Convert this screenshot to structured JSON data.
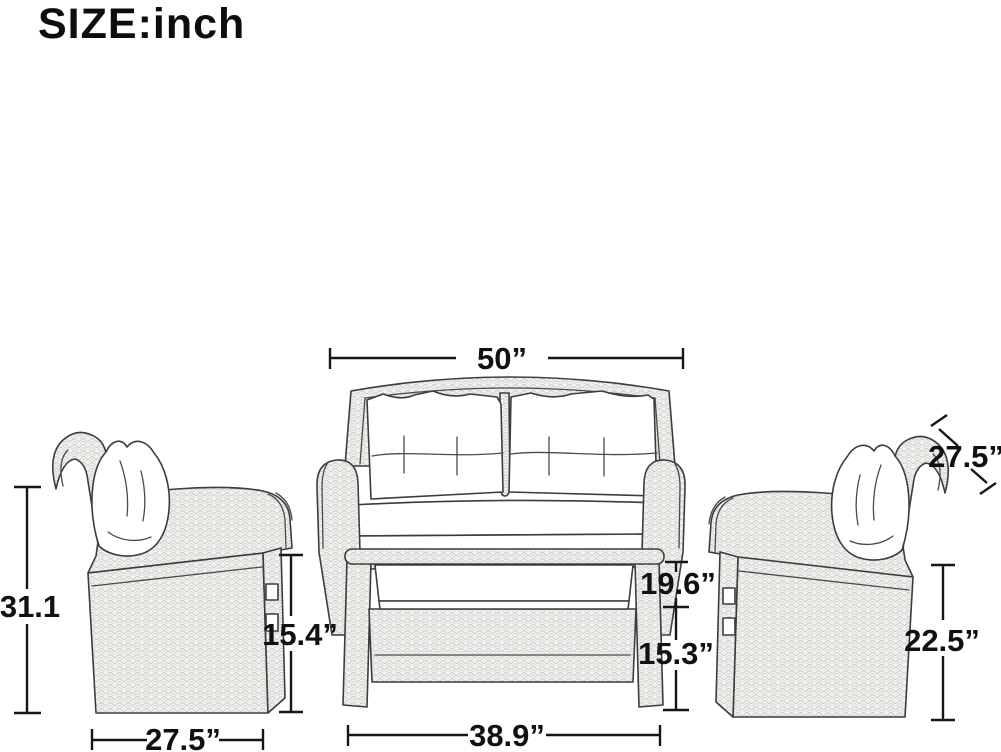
{
  "title": "SIZE:inch",
  "dimensions": {
    "loveseat_width": "50”",
    "left_chair_total_height": "31.1",
    "left_chair_arm_height": "15.4”",
    "left_chair_depth": "27.5”",
    "loveseat_seat_height": "19.6”",
    "table_height": "15.3”",
    "table_width": "38.9”",
    "right_chair_back_height": "27.5”",
    "right_chair_height": "22.5”"
  }
}
